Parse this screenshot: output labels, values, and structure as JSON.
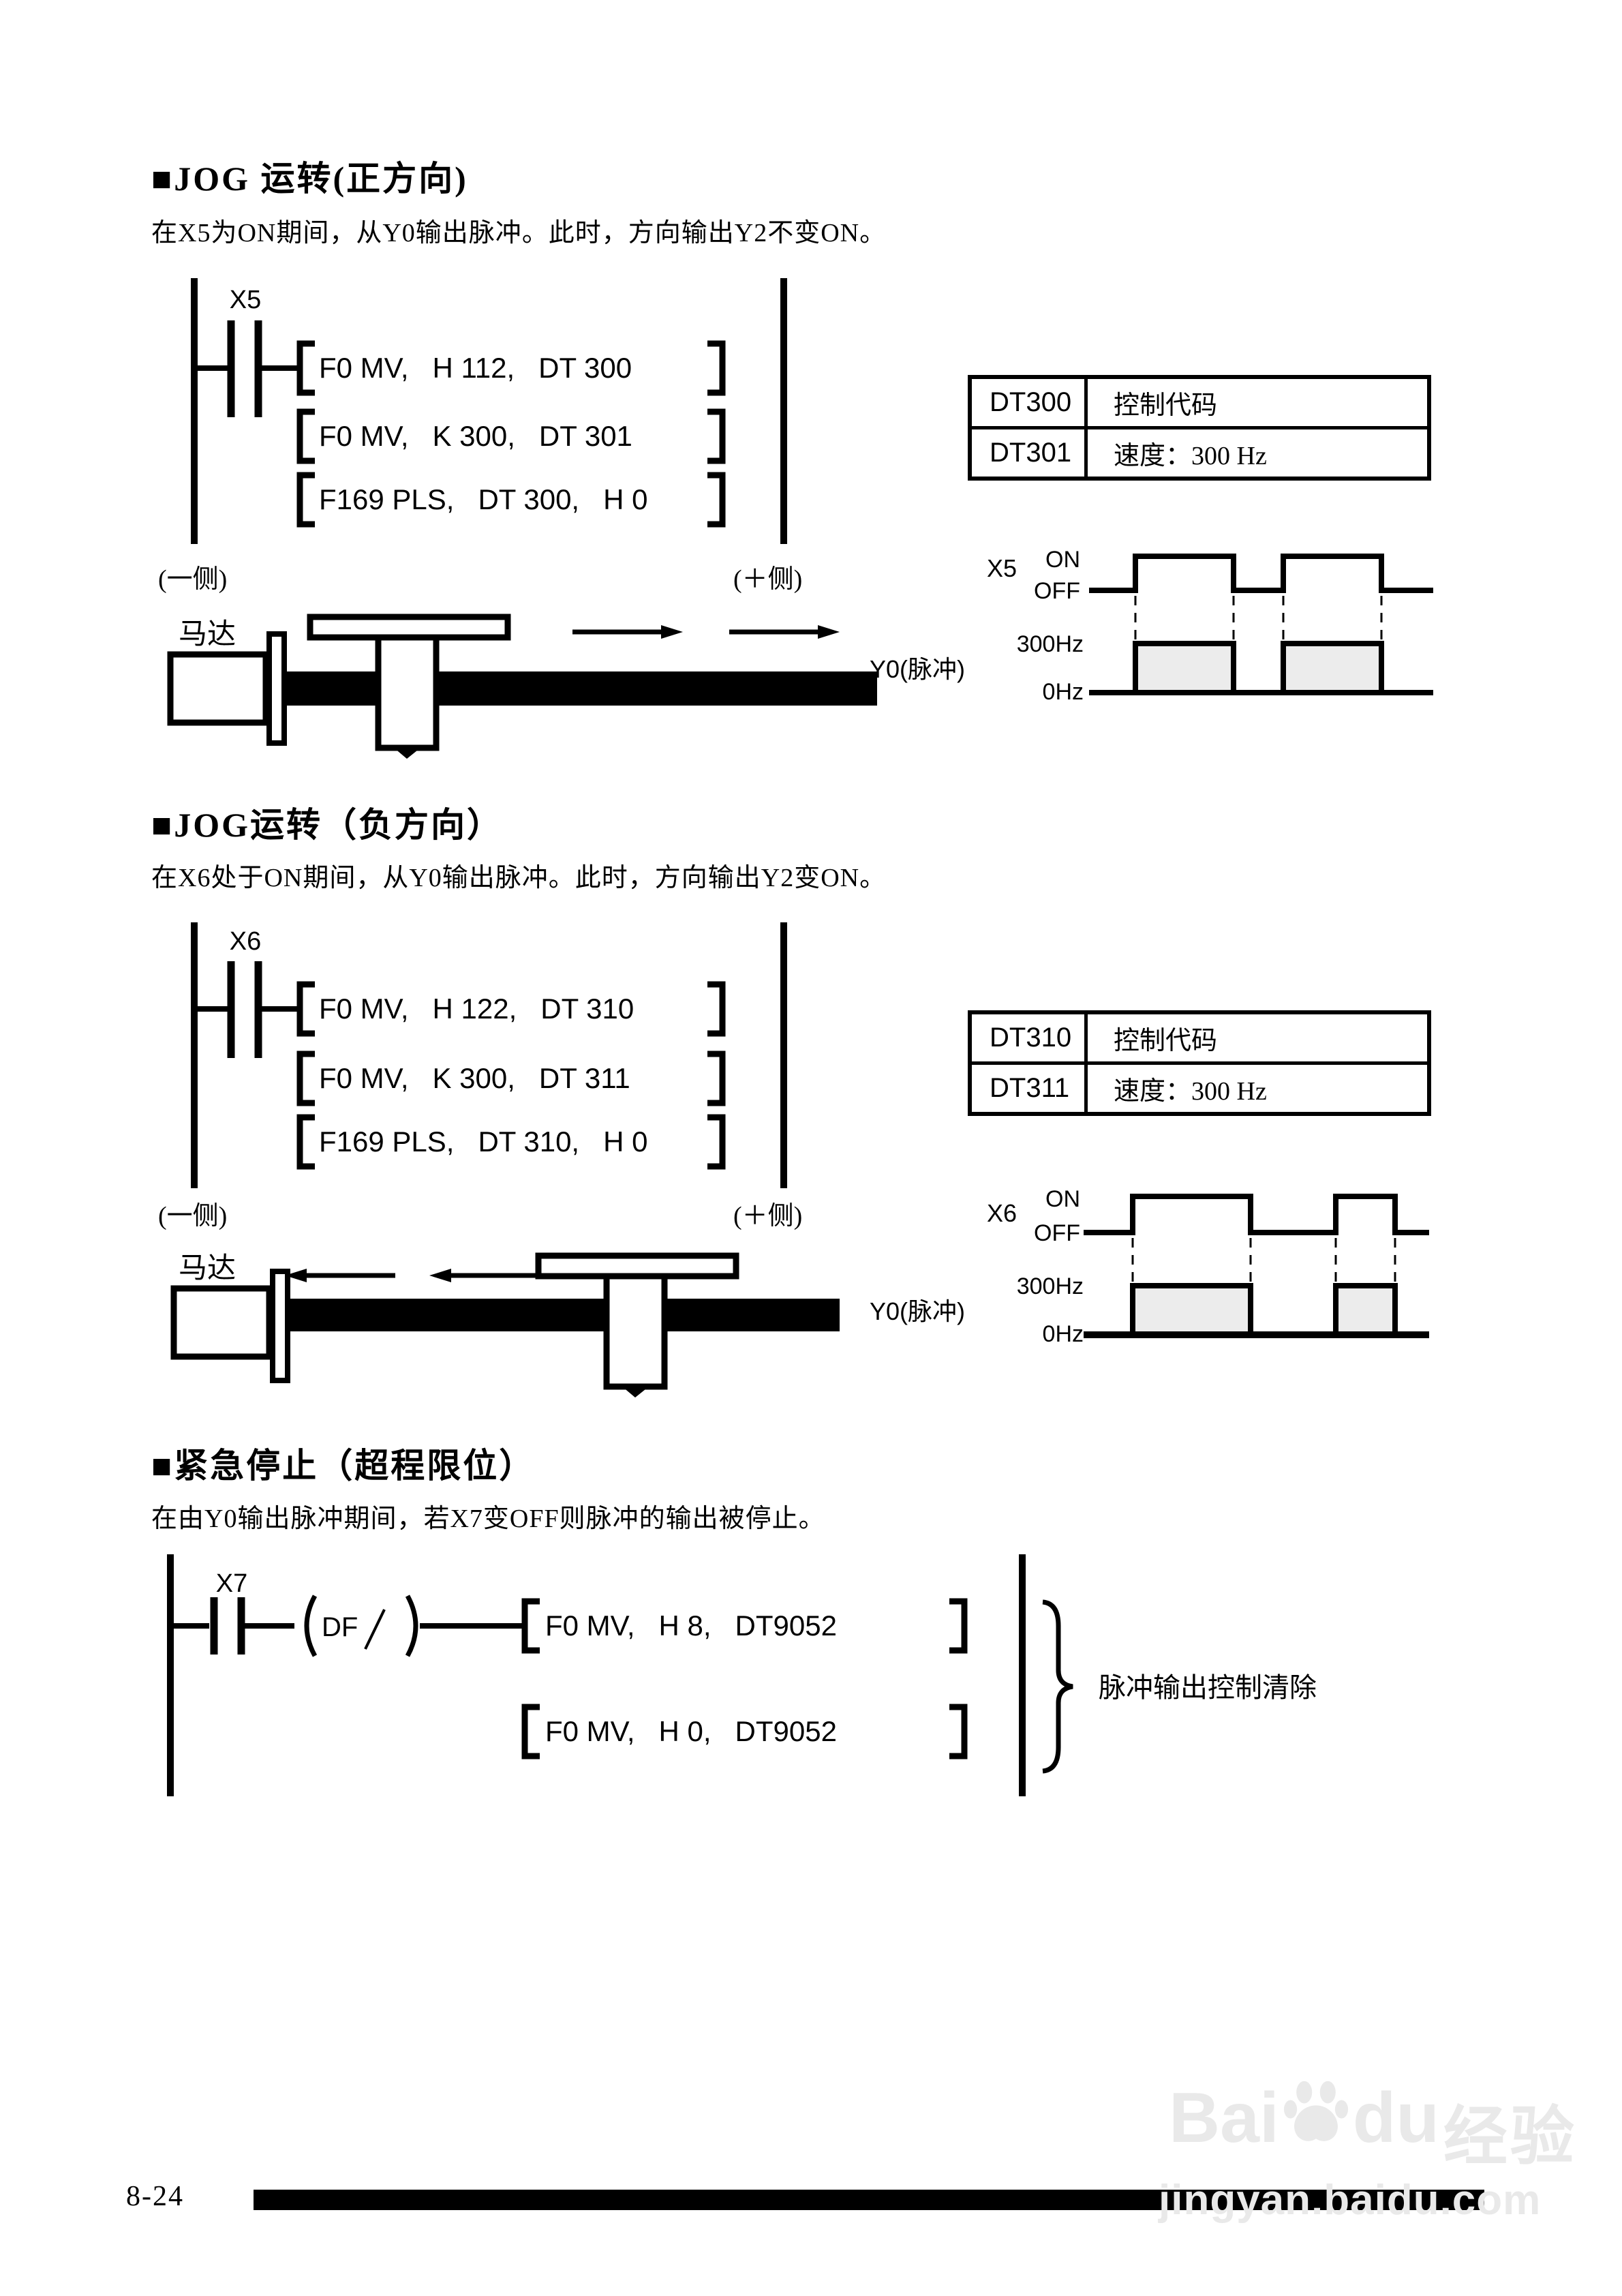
{
  "sections": {
    "jog_forward": {
      "title": "■JOG 运转(正方向)",
      "description": "在X5为ON期间，从Y0输出脉冲。此时，方向输出Y2不变ON。",
      "ladder": {
        "contact_label": "X5",
        "rung1": "F0 MV,   H 112,   DT 300",
        "rung2": "F0 MV,   K 300,   DT 301",
        "rung3": "F169 PLS,   DT 300,   H 0"
      },
      "register_table": {
        "r1c1": "DT300",
        "r1c2": "控制代码",
        "r2c1": "DT301",
        "r2c2": "速度：300 Hz"
      },
      "axis": {
        "minus_label": "(一侧)",
        "plus_label": "(＋侧)",
        "motor_label": "马达"
      },
      "timing": {
        "input_label": "X5",
        "on": "ON",
        "off": "OFF",
        "freq_high": "300Hz",
        "freq_low": "0Hz",
        "output_label": "Y0(脉冲)"
      }
    },
    "jog_reverse": {
      "title": "■JOG运转（负方向）",
      "description": "在X6处于ON期间，从Y0输出脉冲。此时，方向输出Y2变ON。",
      "ladder": {
        "contact_label": "X6",
        "rung1": "F0 MV,   H 122,   DT 310",
        "rung2": "F0 MV,   K 300,   DT 311",
        "rung3": "F169 PLS,   DT 310,   H 0"
      },
      "register_table": {
        "r1c1": "DT310",
        "r1c2": "控制代码",
        "r2c1": "DT311",
        "r2c2": "速度：300 Hz"
      },
      "axis": {
        "minus_label": "(一侧)",
        "plus_label": "(＋侧)",
        "motor_label": "马达"
      },
      "timing": {
        "input_label": "X6",
        "on": "ON",
        "off": "OFF",
        "freq_high": "300Hz",
        "freq_low": "0Hz",
        "output_label": "Y0(脉冲)"
      }
    },
    "emergency_stop": {
      "title": "■紧急停止（超程限位）",
      "description": "在由Y0输出脉冲期间，若X7变OFF则脉冲的输出被停止。",
      "ladder": {
        "contact_label": "X7",
        "edge_label": "DF",
        "rung1": "F0 MV,   H 8,   DT9052",
        "rung2": "F0 MV,   H 0,   DT9052",
        "brace_label": "脉冲输出控制清除"
      }
    }
  },
  "footer": {
    "page_number": "8-24"
  },
  "watermark": {
    "logo_bai": "Bai",
    "logo_du": "du",
    "logo_cn": "经验",
    "url": "jingyan.baidu.com"
  }
}
